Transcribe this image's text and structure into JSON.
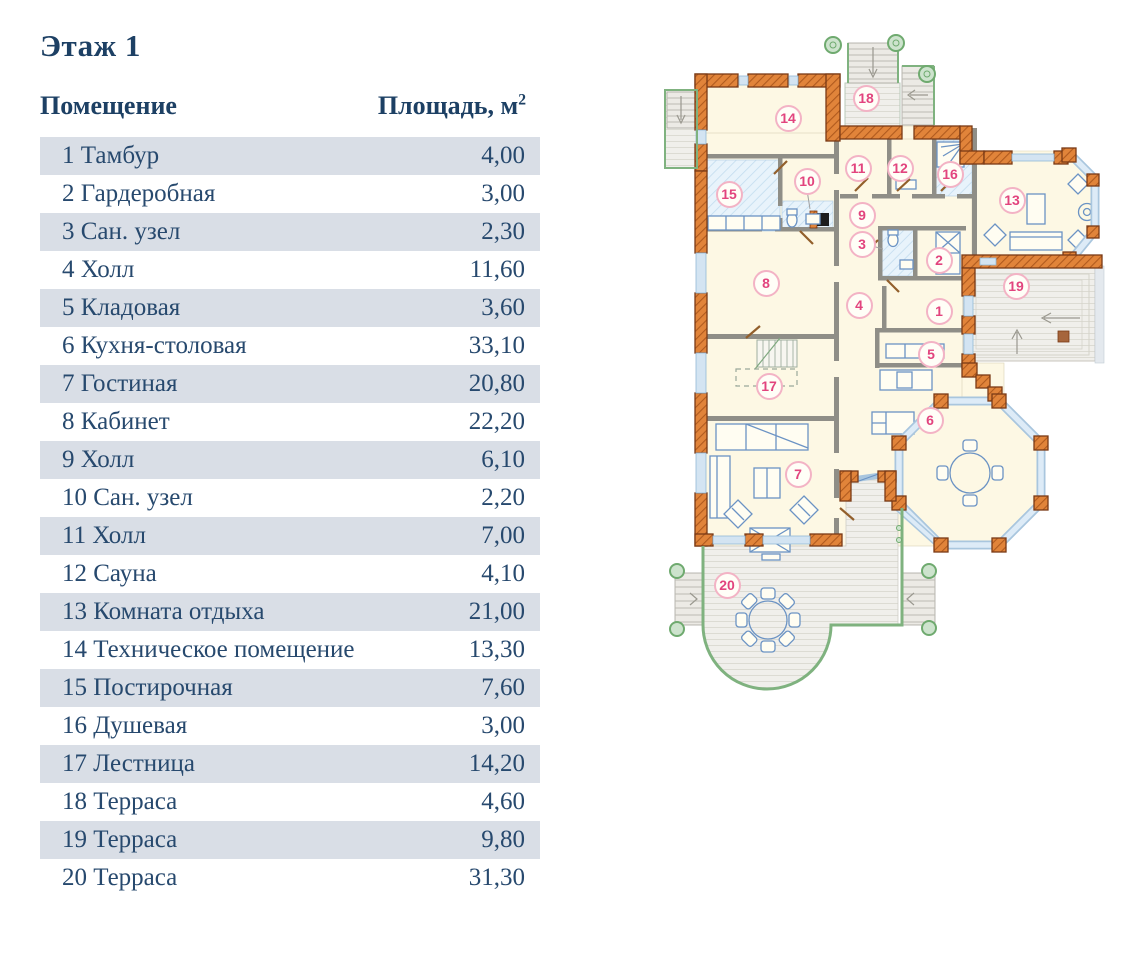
{
  "table": {
    "title": "Этаж 1",
    "columns": {
      "room": "Помещение",
      "area_label": "Площадь, м",
      "area_sup": "2"
    },
    "rows": [
      {
        "num": "1",
        "name": "Тамбур",
        "area": "4,00"
      },
      {
        "num": "2",
        "name": "Гардеробная",
        "area": "3,00"
      },
      {
        "num": "3",
        "name": "Сан. узел",
        "area": "2,30"
      },
      {
        "num": "4",
        "name": "Холл",
        "area": "11,60"
      },
      {
        "num": "5",
        "name": "Кладовая",
        "area": "3,60"
      },
      {
        "num": "6",
        "name": "Кухня-столовая",
        "area": "33,10"
      },
      {
        "num": "7",
        "name": "Гостиная",
        "area": "20,80"
      },
      {
        "num": "8",
        "name": "Кабинет",
        "area": "22,20"
      },
      {
        "num": "9",
        "name": "Холл",
        "area": "6,10"
      },
      {
        "num": "10",
        "name": "Сан. узел",
        "area": "2,20"
      },
      {
        "num": "11",
        "name": "Холл",
        "area": "7,00"
      },
      {
        "num": "12",
        "name": "Сауна",
        "area": "4,10"
      },
      {
        "num": "13",
        "name": "Комната отдыха",
        "area": "21,00"
      },
      {
        "num": "14",
        "name": "Техническое помещение",
        "area": "13,30"
      },
      {
        "num": "15",
        "name": "Постирочная",
        "area": "7,60"
      },
      {
        "num": "16",
        "name": "Душевая",
        "area": "3,00"
      },
      {
        "num": "17",
        "name": "Лестница",
        "area": "14,20"
      },
      {
        "num": "18",
        "name": "Терраса",
        "area": "4,60"
      },
      {
        "num": "19",
        "name": "Терраса",
        "area": "9,80"
      },
      {
        "num": "20",
        "name": "Терраса",
        "area": "31,30"
      }
    ]
  },
  "plan": {
    "labels": [
      {
        "n": "1",
        "x": 289,
        "y": 283
      },
      {
        "n": "2",
        "x": 289,
        "y": 232
      },
      {
        "n": "3",
        "x": 212,
        "y": 216
      },
      {
        "n": "4",
        "x": 209,
        "y": 277
      },
      {
        "n": "5",
        "x": 281,
        "y": 326
      },
      {
        "n": "6",
        "x": 280,
        "y": 392
      },
      {
        "n": "7",
        "x": 148,
        "y": 446
      },
      {
        "n": "8",
        "x": 116,
        "y": 255
      },
      {
        "n": "9",
        "x": 212,
        "y": 187
      },
      {
        "n": "10",
        "x": 157,
        "y": 153
      },
      {
        "n": "11",
        "x": 208,
        "y": 140
      },
      {
        "n": "12",
        "x": 250,
        "y": 140
      },
      {
        "n": "13",
        "x": 362,
        "y": 172
      },
      {
        "n": "14",
        "x": 138,
        "y": 90
      },
      {
        "n": "15",
        "x": 79,
        "y": 166
      },
      {
        "n": "16",
        "x": 300,
        "y": 146
      },
      {
        "n": "17",
        "x": 119,
        "y": 358
      },
      {
        "n": "18",
        "x": 216,
        "y": 70
      },
      {
        "n": "19",
        "x": 366,
        "y": 258
      },
      {
        "n": "20",
        "x": 77,
        "y": 557
      }
    ],
    "colors": {
      "wall_orange": "#e1843a",
      "wall_outline": "#7a3a16",
      "room_fill": "#fdf8e4",
      "window_blue": "#d3e4f2",
      "wet_room_fill": "#e8f3fb",
      "terrace_fill": "#f0efeb",
      "railing_green": "#7fb27f",
      "furniture_blue": "#6b93c4",
      "label_pink": "#e2447e",
      "text_navy": "#1d4064",
      "row_shade": "#d9dee6"
    }
  }
}
